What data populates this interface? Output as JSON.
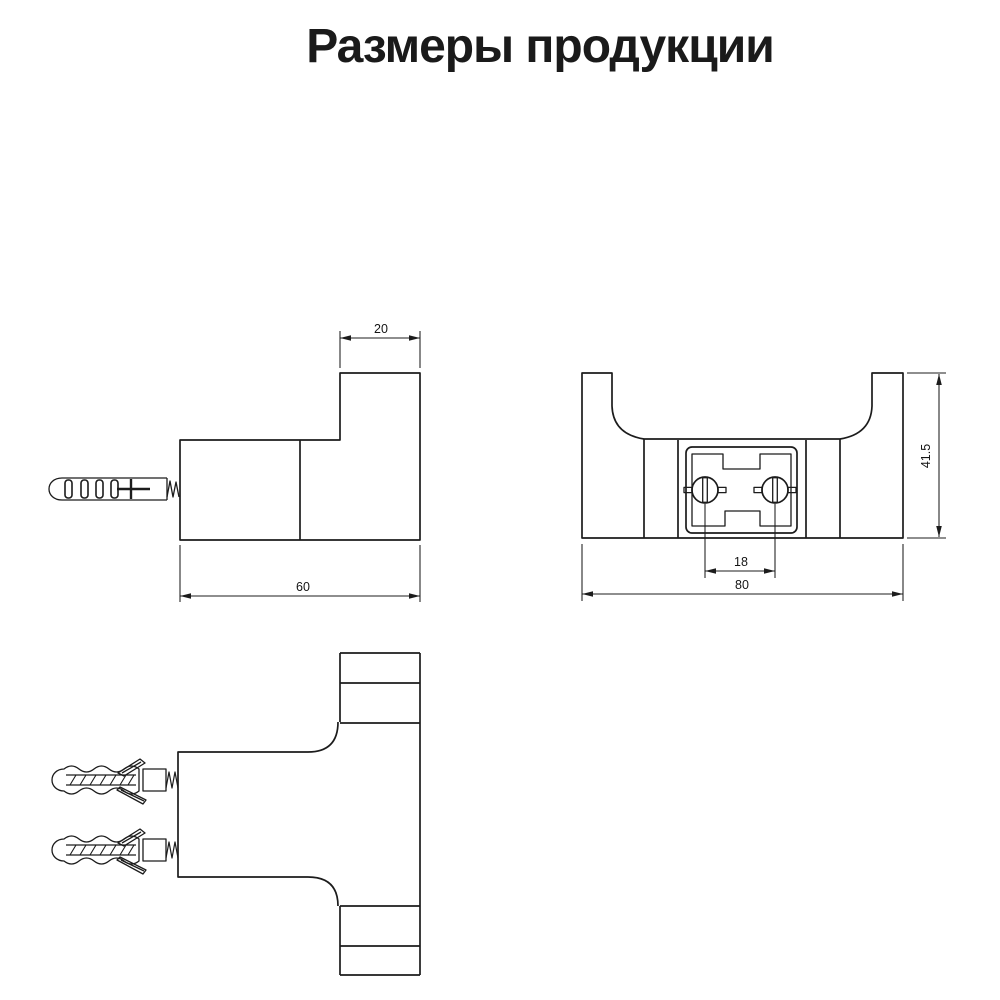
{
  "title": "Размеры продукции",
  "colors": {
    "background": "#ffffff",
    "line": "#1c1c1c",
    "title_text": "#1a1a1a"
  },
  "views": {
    "side": {
      "dims": {
        "hook_depth": "20",
        "total_depth": "60"
      }
    },
    "front": {
      "dims": {
        "screw_spacing": "18",
        "total_width": "80",
        "total_height": "41.5"
      }
    }
  }
}
